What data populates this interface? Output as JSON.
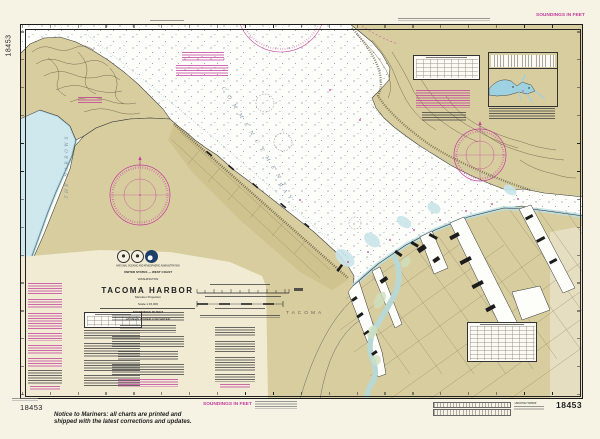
{
  "margins": {
    "soundings_note_top": "SOUNDINGS IN FEET",
    "soundings_note_bottom": "SOUNDINGS IN FEET",
    "chart_number_left": "18453",
    "chart_number_bottom_left": "18453",
    "chart_number_bottom_right": "18453",
    "bottom_right_chart_title": "Tacoma Harbor",
    "notice_line1": "Notice to Mariners: all charts are printed and",
    "notice_line2": "shipped with the latest corrections and updates."
  },
  "title_block": {
    "agency": "NATIONAL OCEANIC AND ATMOSPHERIC ADMINISTRATION",
    "region": "UNITED STATES — WEST COAST",
    "state": "WASHINGTON",
    "title": "TACOMA HARBOR",
    "projection": "Mercator Projection",
    "scale": "Scale 1:15,000",
    "soundings": "SOUNDINGS IN FEET",
    "datum": "AT MEAN LOWER LOW WATER"
  },
  "map_labels": {
    "bay_word1": "COMMENCEMENT",
    "bay_word2": "BAY",
    "narrows": "THE NARROWS",
    "city": "TACOMA"
  },
  "colors": {
    "magenta": "#c23a9c",
    "land": "#d8cd9f",
    "land_dark": "#cec28c",
    "cream": "#f1ebd4",
    "water": "#cfe8ee",
    "paper": "#f7f3e4",
    "ink": "#1f1f1f",
    "contour": "#6f6245",
    "label_blue": "#7e93a6"
  }
}
